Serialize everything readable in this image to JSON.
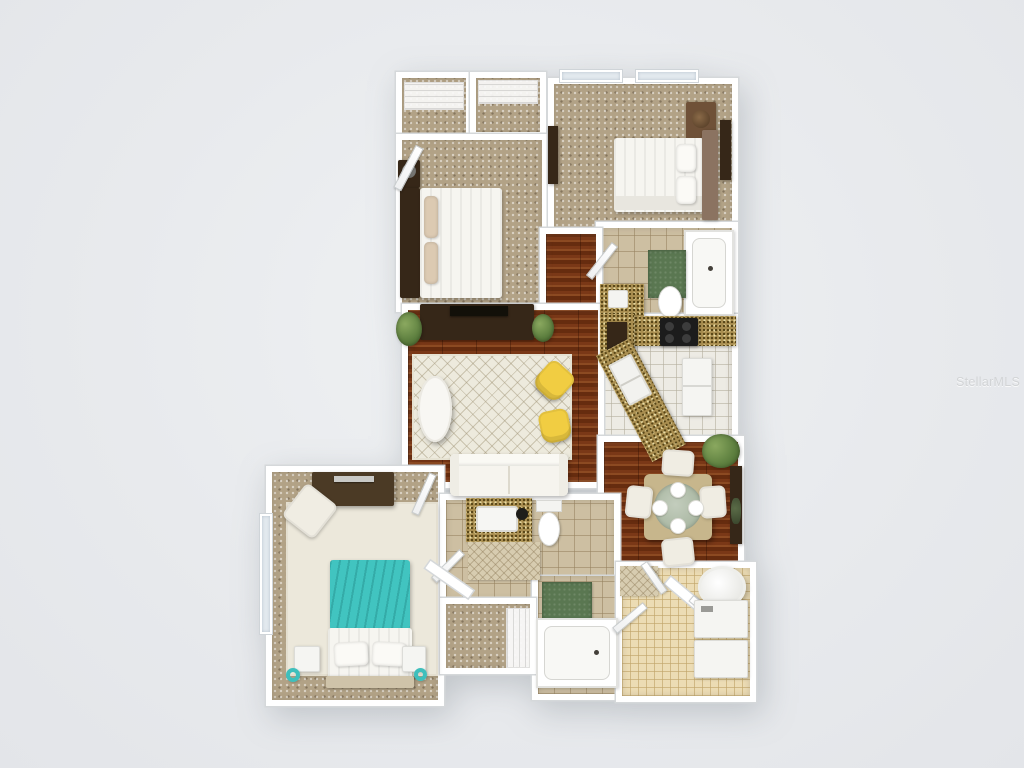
{
  "watermark": {
    "text": "StellarMLS"
  },
  "scene": {
    "type": "3d-floor-plan-top-view",
    "rooms": [
      {
        "name": "walk-in-closet-a",
        "floor": "carpet",
        "furniture": [
          "wire-shelving"
        ]
      },
      {
        "name": "walk-in-closet-b",
        "floor": "carpet",
        "furniture": [
          "wire-shelving"
        ]
      },
      {
        "name": "bedroom-2",
        "floor": "carpet",
        "furniture": [
          "queen-bed-white",
          "dark-headboard",
          "nightstand",
          "tan-pillows",
          "door"
        ]
      },
      {
        "name": "bedroom-3",
        "floor": "carpet",
        "furniture": [
          "queen-bed-white",
          "wood-headboard",
          "nightstand-lamp",
          "wall-art",
          "wall-tv",
          "windows"
        ]
      },
      {
        "name": "bathroom-2",
        "floor": "beige-tile",
        "furniture": [
          "bathtub",
          "toilet",
          "granite-vanity",
          "green-bath-mat"
        ]
      },
      {
        "name": "kitchen",
        "floor": "white-tile",
        "furniture": [
          "granite-counter",
          "black-range-stove",
          "angled-peninsula-double-sink",
          "refrigerator"
        ]
      },
      {
        "name": "hallway",
        "floor": "hardwood",
        "furniture": [
          "granite-top-cabinet"
        ]
      },
      {
        "name": "living-room",
        "floor": "hardwood",
        "furniture": [
          "tv-console-dark",
          "flat-tv",
          "patterned-area-rug",
          "oval-coffee-table",
          "yellow-accent-chair-1",
          "yellow-accent-chair-2",
          "white-sofa",
          "potted-plants"
        ]
      },
      {
        "name": "dining-area",
        "floor": "hardwood",
        "furniture": [
          "square-dining-table",
          "four-upholstered-chairs",
          "four-place-settings",
          "corner-plant",
          "wall-console"
        ]
      },
      {
        "name": "bedroom-1",
        "floor": "carpet",
        "furniture": [
          "teal-bed",
          "white-pillows",
          "two-nightstands",
          "teal-ring-decor",
          "dresser-with-tv",
          "cream-accent-chair",
          "cream-area-rug",
          "window"
        ]
      },
      {
        "name": "bathroom-1",
        "floor": "beige-tile",
        "furniture": [
          "granite-vanity-sink",
          "toilet",
          "patterned-bath-mat",
          "green-bath-mat",
          "bathtub"
        ]
      },
      {
        "name": "walk-in-closet-1",
        "floor": "carpet",
        "furniture": [
          "wire-shelving"
        ]
      },
      {
        "name": "laundry-utility",
        "floor": "small-beige-tile",
        "furniture": [
          "water-heater",
          "washer",
          "dryer",
          "patterned-mat",
          "open-doors"
        ]
      }
    ]
  },
  "colors": {
    "background": "#e9ebed",
    "walls": "#ffffff",
    "wall_edge": "#d5d8da",
    "hardwood": "#7a3817",
    "carpet": "#b2a286",
    "bathroom_tile": "#cdbfa2",
    "kitchen_tile": "#edebe4",
    "laundry_tile": "#ecdcb4",
    "granite_counter": "#a98e50",
    "area_rug": "#edeadd",
    "accent_teal": "#41c4c0",
    "accent_yellow": "#f1cd42",
    "bath_mat_green": "#5a7751",
    "plant_green": "#5d7f3f",
    "dark_furniture": "#362718",
    "watermark_gray": "#d2d4d6"
  }
}
